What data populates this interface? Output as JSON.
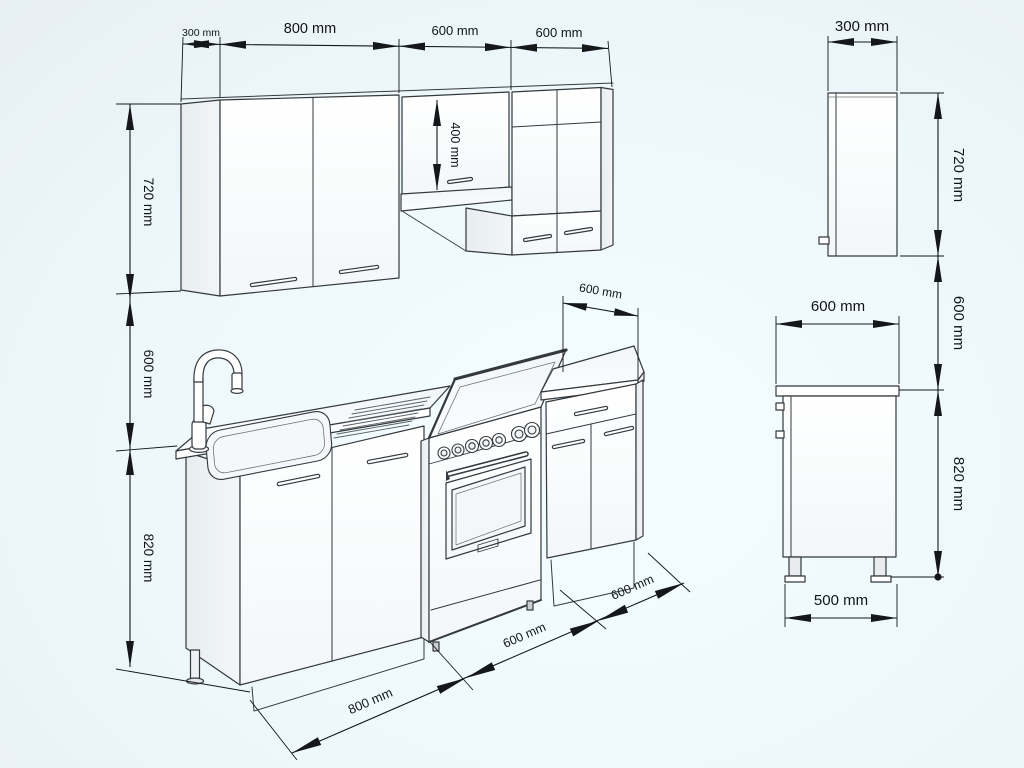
{
  "drawing": {
    "title": "kitchen-set-dimension-drawing",
    "elevation": {
      "top_dims": {
        "side_depth": "300 mm",
        "cab_800": "800 mm",
        "cab_600_a": "600 mm",
        "cab_600_b": "600 mm"
      },
      "left_dims": {
        "wall_cab_height": "720 mm",
        "gap_height": "600 mm",
        "base_height": "820 mm"
      },
      "mid_dim": "400 mm",
      "counter_dim": "600 mm",
      "floor_dims": {
        "sink_cab": "800 mm",
        "stove": "600 mm",
        "base_cab": "600 mm"
      }
    },
    "wall_side_view": {
      "depth": "300 mm",
      "height": "720 mm"
    },
    "base_side_view": {
      "gap": "600 mm",
      "counter_depth": "600 mm",
      "height": "820 mm",
      "body_depth": "500 mm"
    }
  },
  "colors": {
    "background": "#eef8fb",
    "line": "#34393d",
    "dimension": "#15181a",
    "cabinet_front": "#fdfdfe",
    "cabinet_side": "#edf1f3",
    "cabinet_top": "#f6f9fb"
  }
}
